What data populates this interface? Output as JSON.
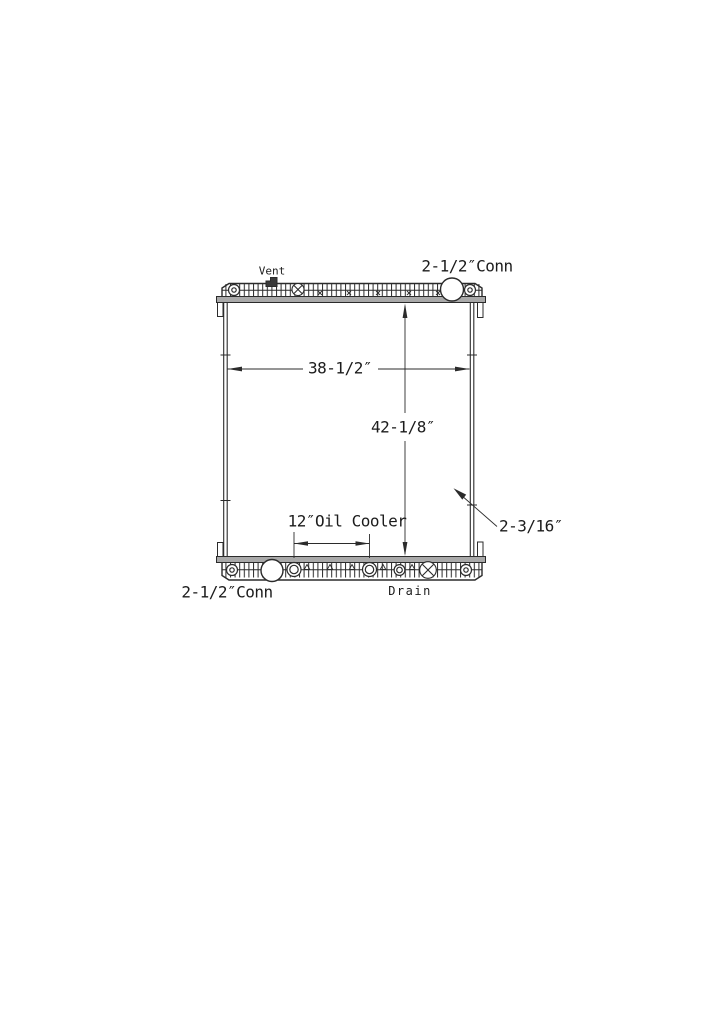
{
  "diagram": {
    "type": "radiator-technical-drawing",
    "labels": {
      "vent": "Vent",
      "top_connection": "2-1/2″Conn",
      "bottom_connection": "2-1/2″Conn",
      "drain": "Drain"
    },
    "dimensions": {
      "core_width": "38-1/2″",
      "core_height": "42-1/8″",
      "oil_cooler": "12″Oil Cooler",
      "depth": "2-3/16″"
    },
    "colors": {
      "line": "#2b2b2b",
      "band": "#a9a9a9",
      "text": "#1c1c1c",
      "background": "#ffffff"
    }
  }
}
